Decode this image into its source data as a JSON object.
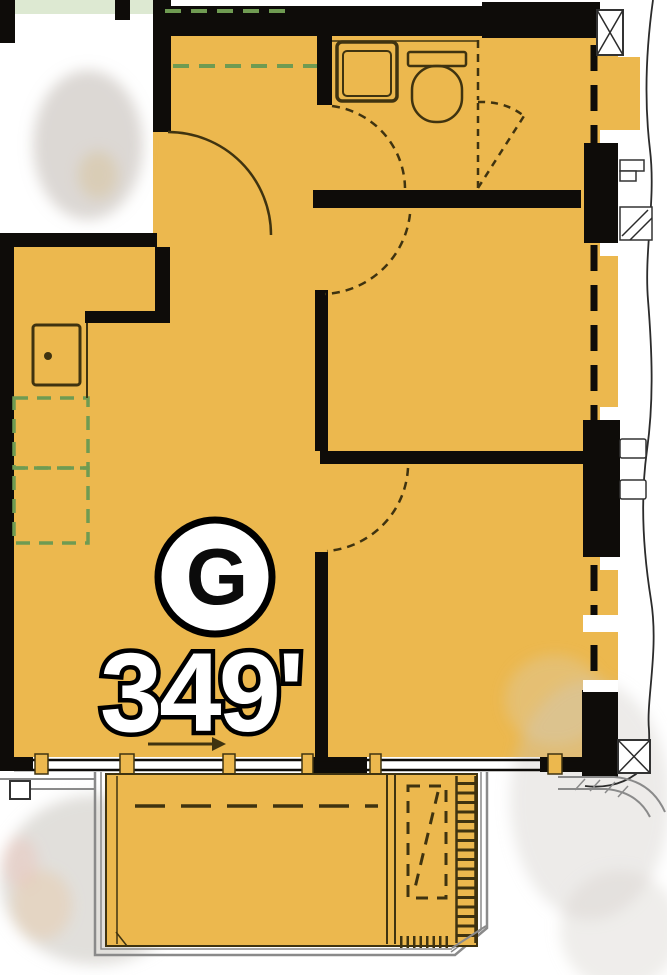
{
  "unit": {
    "label": "G",
    "area": "349'"
  },
  "colors": {
    "floor": "#ECB84E",
    "wall": "#0e0c09",
    "line": "#3f3310",
    "green": "#6f9b52",
    "grey": "#8a8a8a",
    "ext": "#2b2b2b",
    "badge-fill": "#ffffff",
    "badge-stroke": "#000000",
    "area-fill": "#ffffff",
    "area-stroke": "#000000"
  },
  "fixtures": [
    "entry-door-swing",
    "entry-closet-rod-dashed",
    "bathroom-sink",
    "toilet",
    "bathroom-door-swing",
    "closet-folding-door-dashed",
    "bedroom1-door-swing",
    "bedroom2-door-swing",
    "kitchen-sink",
    "kitchen-appliances-dashed",
    "window-wall-mullions",
    "facade-column-blocks",
    "balcony-deck",
    "balcony-ladder-screen",
    "balcony-dashed-unit",
    "exterior-contour-line"
  ]
}
